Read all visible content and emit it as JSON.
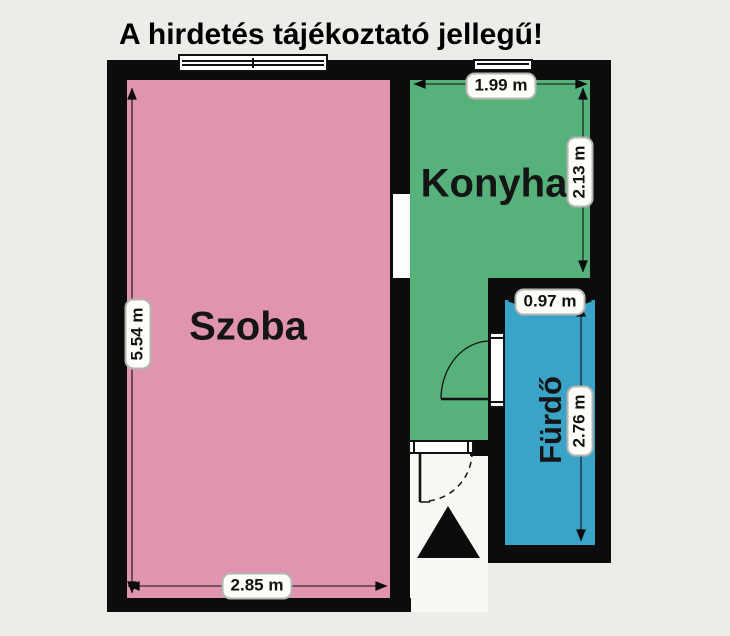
{
  "title": "A hirdetés tájékoztató jellegű!",
  "unit": "m",
  "rooms": {
    "szoba": {
      "label": "Szoba",
      "color": "#e094b0",
      "width": "2.85 m",
      "height": "5.54 m"
    },
    "konyha": {
      "label": "Konyha",
      "color": "#56b17b",
      "width": "1.99 m",
      "height": "2.13 m"
    },
    "furdo": {
      "label": "Fürdő",
      "color": "#3aa3c8",
      "width": "0.97 m",
      "height": "2.76 m"
    }
  },
  "colors": {
    "wall": "#0c0c0c",
    "background": "#eeece8",
    "dimension_label_bg": "#fdfdfa",
    "dimension_label_border": "#b6b6b0",
    "entry_area": "#f8f8f4"
  },
  "symbols": {
    "entrance_marker_icon": "filled-triangle-up",
    "door_icon": "swing-arc-with-leaf",
    "window_icon": "double-line-window"
  }
}
